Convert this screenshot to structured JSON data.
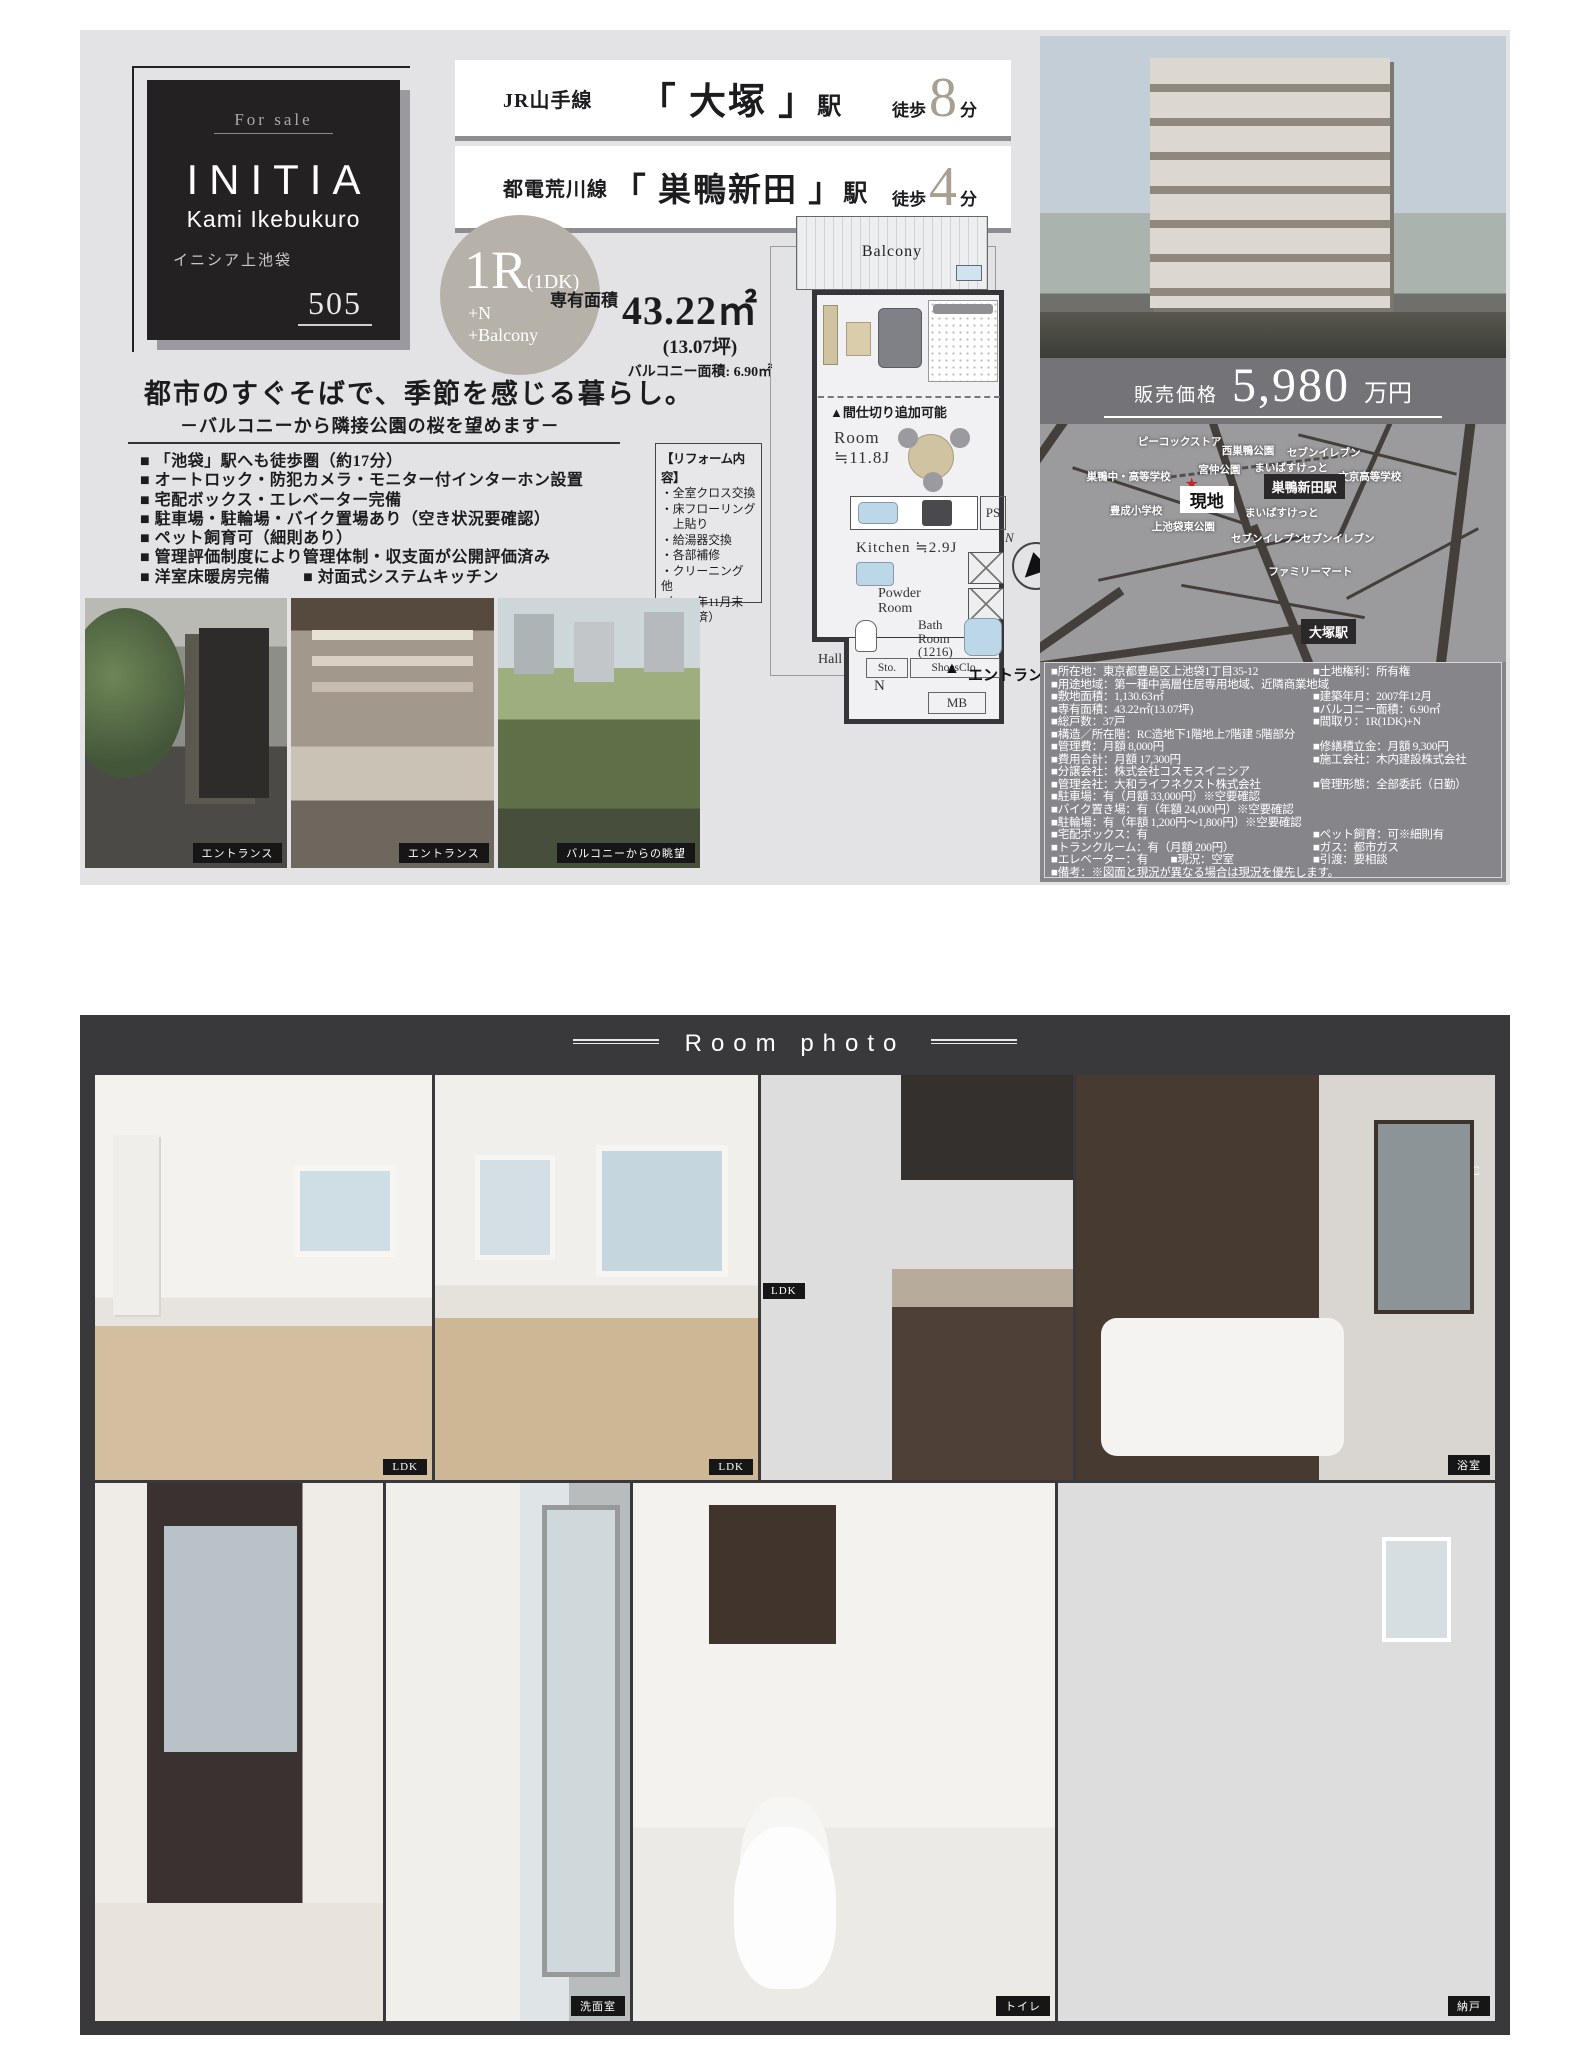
{
  "card": {
    "for_sale": "For  sale",
    "brand": "INITIA",
    "name_en": "Kami Ikebukuro",
    "name_jp": "イニシア上池袋",
    "unit": "505"
  },
  "access": {
    "rows": [
      {
        "line": "JR山手線",
        "station": "「 大塚 」",
        "suffix": "駅",
        "walk": "徒歩",
        "minutes": "8",
        "unit": "分"
      },
      {
        "line": "都電荒川線",
        "station": "「 巣鴨新田 」",
        "suffix": "駅",
        "walk": "徒歩",
        "minutes": "4",
        "unit": "分"
      }
    ]
  },
  "unit_badge": {
    "main": "1R",
    "sub": "(1DK)",
    "plus_n": "+N",
    "plus_balcony": "+Balcony"
  },
  "area": {
    "label": "専有面積",
    "value": "43.22㎡",
    "tsubo": "(13.07坪)",
    "balcony": "バルコニー面積: 6.90㎡"
  },
  "catch": {
    "main": "都市のすぐそばで、季節を感じる暮らし。",
    "sub": "－バルコニーから隣接公園の桜を望めます－"
  },
  "features": [
    "■ 「池袋」駅へも徒歩圏（約17分）",
    "■ オートロック・防犯カメラ・モニター付インターホン設置",
    "■ 宅配ボックス・エレベーター完備",
    "■ 駐車場・駐輪場・バイク置場あり（空き状況要確認）",
    "■ ペット飼育可（細則あり）",
    "■ 管理評価制度により管理体制・収支面が公開評価済み",
    "■ 洋室床暖房完備　　■ 対面式システムキッチン"
  ],
  "reform": {
    "title": "【リフォーム内容】",
    "lines": [
      "・全室クロス交換",
      "・床フローリング",
      "　上貼り",
      "・給湯器交換",
      "・各部補修",
      "・クリーニング 他",
      "（2025年11月末",
      "　完成済）"
    ]
  },
  "floorplan": {
    "balcony": "Balcony",
    "partition": "▲間仕切り追加可能",
    "room": "Room",
    "room_size": "≒11.8J",
    "ps": "PS",
    "kitchen": "Kitchen ≒2.9J",
    "powder_1": "Powder",
    "powder_2": "Room",
    "bath_1": "Bath",
    "bath_2": "Room",
    "bath_size": "(1216)",
    "hall": "Hall",
    "sto": "Sto.",
    "shoes": "ShoesClo.",
    "n_room": "N",
    "mb": "MB",
    "entrance_marker": "▲",
    "entrance": "エントランス",
    "compass_n": "N"
  },
  "exterior_caption": "外観写真",
  "price": {
    "label": "販売価格",
    "amount": "5,980",
    "unit": "万円"
  },
  "map": {
    "site_star": "★",
    "labels": [
      {
        "text": "ピーコックストア",
        "x": 21,
        "y": 4,
        "type": "poi"
      },
      {
        "text": "西巣鴨公園",
        "x": 39,
        "y": 8,
        "type": "poi"
      },
      {
        "text": "セブンイレブン",
        "x": 53,
        "y": 9,
        "type": "poi"
      },
      {
        "text": "巣鴨中・高等学校",
        "x": 10,
        "y": 19,
        "type": "poi"
      },
      {
        "text": "宮仲公園",
        "x": 34,
        "y": 16,
        "type": "poi"
      },
      {
        "text": "まいばすけっと",
        "x": 46,
        "y": 15,
        "type": "poi"
      },
      {
        "text": "文京高等学校",
        "x": 64,
        "y": 19,
        "type": "poi"
      },
      {
        "text": "巣鴨新田駅",
        "x": 48,
        "y": 21,
        "type": "station"
      },
      {
        "text": "現地",
        "x": 30,
        "y": 26,
        "type": "site"
      },
      {
        "text": "豊成小学校",
        "x": 15,
        "y": 33,
        "type": "poi"
      },
      {
        "text": "まいばすけっと",
        "x": 44,
        "y": 34,
        "type": "poi"
      },
      {
        "text": "上池袋東公園",
        "x": 24,
        "y": 40,
        "type": "poi"
      },
      {
        "text": "セブンイレブン",
        "x": 41,
        "y": 45,
        "type": "poi"
      },
      {
        "text": "セブンイレブン",
        "x": 56,
        "y": 45,
        "type": "poi"
      },
      {
        "text": "ファミリーマート",
        "x": 49,
        "y": 59,
        "type": "poi"
      },
      {
        "text": "大塚駅",
        "x": 56,
        "y": 82,
        "type": "station"
      }
    ]
  },
  "details": {
    "rows": [
      {
        "l": "■所在地：東京都豊島区上池袋1丁目35-12",
        "r": "■土地権利：所有権"
      },
      {
        "l": "■用途地域：第一種中高層住居専用地域、近隣商業地域",
        "r": ""
      },
      {
        "l": "■敷地面積：1,130.63㎡",
        "r": "■建築年月：2007年12月"
      },
      {
        "l": "■専有面積：43.22㎡(13.07坪)",
        "r": "■バルコニー面積：6.90㎡"
      },
      {
        "l": "■総戸数：37戸",
        "r": "■間取り：1R(1DK)+N"
      },
      {
        "l": "■構造／所在階：RC造地下1階地上7階建 5階部分",
        "r": ""
      },
      {
        "l": "■管理費：月額 8,000円",
        "r": "■修繕積立金：月額 9,300円"
      },
      {
        "l": "■費用合計：月額 17,300円",
        "r": "■施工会社：木内建設株式会社"
      },
      {
        "l": "■分譲会社：株式会社コスモスイニシア",
        "r": ""
      },
      {
        "l": "■管理会社：大和ライフネクスト株式会社",
        "r": "■管理形態：全部委託（日勤）"
      },
      {
        "l": "■駐車場：有（月額 33,000円）※空要確認",
        "r": ""
      },
      {
        "l": "■バイク置き場：有（年額 24,000円）※空要確認",
        "r": ""
      },
      {
        "l": "■駐輪場：有（年額 1,200円～1,800円）※空要確認",
        "r": ""
      },
      {
        "l": "■宅配ボックス：有",
        "r": "■ペット飼育：可※細則有"
      },
      {
        "l": "■トランクルーム：有（月額 200円）",
        "r": "■ガス：都市ガス"
      },
      {
        "l": "■エレベーター：有　　■現況：空室",
        "r": "■引渡：要相談"
      },
      {
        "l": "■備考：※図面と現況が異なる場合は現況を優先します。",
        "r": ""
      }
    ]
  },
  "gallery": [
    {
      "caption": "エントランス"
    },
    {
      "caption": "エントランス"
    },
    {
      "caption": "バルコニーからの眺望"
    }
  ],
  "room_photos": {
    "header": "Room photo",
    "tags": {
      "wic": "WIC",
      "ldk_inset": "LDK"
    },
    "rows": [
      [
        {
          "caption": "LDK"
        },
        {
          "caption": "LDK"
        },
        {
          "caption": "キッチン"
        },
        {
          "caption": "浴室"
        }
      ],
      [
        {
          "caption": "洗面室"
        },
        {
          "caption": "洗面室"
        },
        {
          "caption": "トイレ"
        },
        {
          "caption": "納戸"
        }
      ]
    ]
  }
}
